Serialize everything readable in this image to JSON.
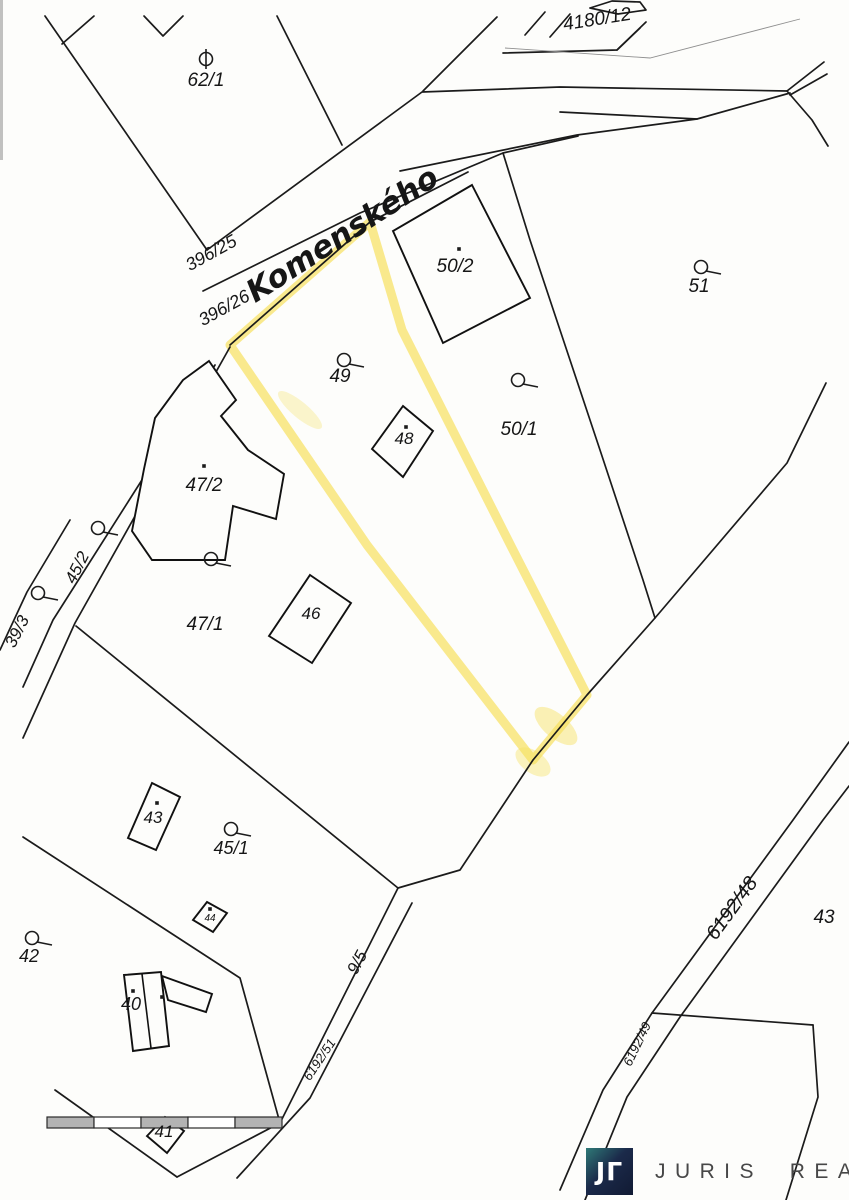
{
  "map": {
    "ink_color": "#1b1b1b",
    "highlight_color": "#f6e05e",
    "street_name": "Komenského",
    "street_color": "#2b3fa8",
    "labels": [
      {
        "text": "4180/12",
        "x": 598,
        "y": 25,
        "rot": -9,
        "size": 19
      },
      {
        "text": "62/1",
        "x": 206,
        "y": 86,
        "rot": 0,
        "size": 19
      },
      {
        "text": "396/25",
        "x": 214,
        "y": 258,
        "rot": -29,
        "size": 18
      },
      {
        "text": "396/26",
        "x": 227,
        "y": 313,
        "rot": -29,
        "size": 18
      },
      {
        "text": "50/2",
        "x": 455,
        "y": 272,
        "rot": 0,
        "size": 19
      },
      {
        "text": "51",
        "x": 699,
        "y": 292,
        "rot": 0,
        "size": 19
      },
      {
        "text": "49",
        "x": 340,
        "y": 382,
        "rot": 0,
        "size": 19
      },
      {
        "text": "48",
        "x": 404,
        "y": 444,
        "rot": 0,
        "size": 17
      },
      {
        "text": "50/1",
        "x": 519,
        "y": 435,
        "rot": 0,
        "size": 19
      },
      {
        "text": "47/2",
        "x": 204,
        "y": 491,
        "rot": 0,
        "size": 19
      },
      {
        "text": "45/2",
        "x": 82,
        "y": 570,
        "rot": -63,
        "size": 17
      },
      {
        "text": "39/3",
        "x": 22,
        "y": 634,
        "rot": -63,
        "size": 17
      },
      {
        "text": "47/1",
        "x": 205,
        "y": 630,
        "rot": 0,
        "size": 19
      },
      {
        "text": "46",
        "x": 311,
        "y": 619,
        "rot": 0,
        "size": 17
      },
      {
        "text": "43",
        "x": 153,
        "y": 823,
        "rot": 0,
        "size": 17
      },
      {
        "text": "45/1",
        "x": 231,
        "y": 854,
        "rot": 0,
        "size": 18
      },
      {
        "text": "44",
        "x": 210,
        "y": 921,
        "rot": 0,
        "size": 10
      },
      {
        "text": "42",
        "x": 29,
        "y": 962,
        "rot": 0,
        "size": 18
      },
      {
        "text": "9/5",
        "x": 362,
        "y": 965,
        "rot": -62,
        "size": 17
      },
      {
        "text": "40",
        "x": 131,
        "y": 1010,
        "rot": 0,
        "size": 18
      },
      {
        "text": "6192/51",
        "x": 323,
        "y": 1062,
        "rot": -56,
        "size": 13
      },
      {
        "text": "6192/48",
        "x": 737,
        "y": 912,
        "rot": -54,
        "size": 20
      },
      {
        "text": "43",
        "x": 824,
        "y": 923,
        "rot": 0,
        "size": 19
      },
      {
        "text": "6192/49",
        "x": 641,
        "y": 1046,
        "rot": -64,
        "size": 13
      },
      {
        "text": "41",
        "x": 164,
        "y": 1137,
        "rot": 0,
        "size": 17
      }
    ],
    "street_label": {
      "x": 348,
      "y": 243,
      "rot": -33,
      "size": 31
    },
    "symbols": [
      {
        "type": "orchard",
        "x": 206,
        "y": 59
      },
      {
        "type": "garden",
        "x": 344,
        "y": 360
      },
      {
        "type": "garden",
        "x": 518,
        "y": 380
      },
      {
        "type": "garden",
        "x": 701,
        "y": 267
      },
      {
        "type": "garden",
        "x": 98,
        "y": 528
      },
      {
        "type": "garden",
        "x": 211,
        "y": 559
      },
      {
        "type": "garden",
        "x": 38,
        "y": 593
      },
      {
        "type": "garden",
        "x": 231,
        "y": 829
      },
      {
        "type": "garden",
        "x": 32,
        "y": 938
      }
    ],
    "dots": [
      [
        459,
        249
      ],
      [
        406,
        427
      ],
      [
        204,
        466
      ],
      [
        157,
        803
      ],
      [
        210,
        909
      ],
      [
        133,
        991
      ],
      [
        162,
        997
      ]
    ]
  },
  "scalebar": {
    "y": 1117,
    "height": 11,
    "segments": [
      {
        "x": 47,
        "w": 47,
        "color": "#b3b3b3"
      },
      {
        "x": 94,
        "w": 47,
        "color": "#ffffff"
      },
      {
        "x": 141,
        "w": 47,
        "color": "#b3b3b3"
      },
      {
        "x": 188,
        "w": 47,
        "color": "#ffffff"
      },
      {
        "x": 235,
        "w": 47,
        "color": "#b3b3b3"
      }
    ],
    "border_color": "#2a2a2a"
  },
  "logo": {
    "glyph_left": "J",
    "glyph_right": "Γ",
    "text": "JURIS REAL"
  }
}
